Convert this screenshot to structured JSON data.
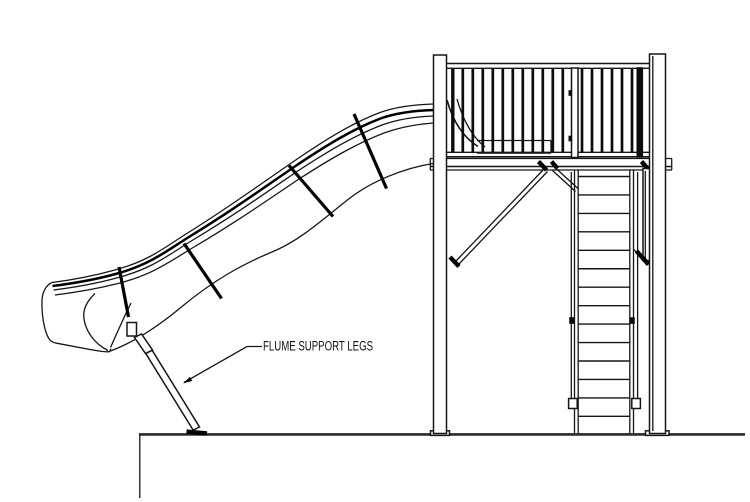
{
  "annotation": {
    "label": "FLUME SUPPORT LEGS"
  },
  "drawing": {
    "background": "#ffffff",
    "line_color": "#161616",
    "accent_color": "#000000",
    "flume": {
      "profile_line_count": 4,
      "support_tie_count": 4
    },
    "railing": {
      "left_baluster_count": 12,
      "right_baluster_count": 6,
      "baluster_pitch_px": 10,
      "baluster_top_y": 69,
      "baluster_bottom_y": 152.5,
      "left_start_x": 452.8,
      "right_start_x": 582
    },
    "stairs": {
      "step_count": 14,
      "step_left_x": 578.5,
      "step_right_x": 629.5,
      "first_step_y": 176.5,
      "step_pitch_px": 18.45
    }
  }
}
